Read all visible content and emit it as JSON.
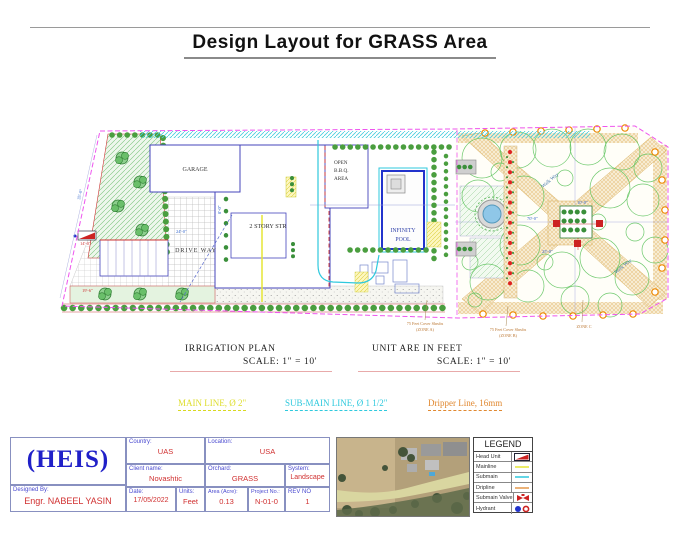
{
  "title": "Design Layout for GRASS Area",
  "plan": {
    "labels": {
      "garage": "GARAGE",
      "two_story": "2 STORY STR",
      "driveway": "DRIVE WAY",
      "bbq1": "OPEN",
      "bbq2": "B.B.Q.",
      "bbq3": "AREA",
      "pool1": "INFINITY",
      "pool2": "POOL",
      "walkway": "Walk Way"
    },
    "dims": {
      "d35": "35'-0\"",
      "d24": "24'-0\"",
      "d14": "14'-0\"",
      "d8": "8'-0\"",
      "d19": "19'-6\"",
      "d70": "70'-0\"",
      "d10": "10'-0\"",
      "d25": "25'-0\""
    },
    "annotations": {
      "a1l1": "75 Feet Cover Shrubs",
      "a1l2": "(ZONE A)",
      "a2l1": "75 Feet Cover Shrubs",
      "a2l2": "(ZONE B)",
      "a3": "ZONE C"
    }
  },
  "notes": {
    "irrigation": "IRRIGATION PLAN",
    "scale_left": "SCALE: 1\" = 10'",
    "units": "UNIT ARE IN FEET",
    "scale_right": "SCALE: 1\" = 10'"
  },
  "pipes": {
    "main": "MAIN LINE, Ø 2\"",
    "submain": "SUB-MAIN LINE, Ø  1 1/2\"",
    "dripper": "Dripper Line, 16mm"
  },
  "titleblock": {
    "logo": "(HEIS)",
    "designed_by_label": "Designed  By:",
    "designed_by": "Engr. NABEEL YASIN",
    "country_label": "Country:",
    "country": "UAS",
    "location_label": "Location:",
    "location": "USA",
    "client_label": "Client  name:",
    "client": "Novashtic",
    "orchard_label": "Orchard:",
    "orchard": "GRASS",
    "system_label": "System:",
    "system": "Landscape",
    "date_label": "Date:",
    "date": "17/05/2022",
    "units_label": "Units:",
    "units": "Feet",
    "area_label": "Area  (Acre):",
    "area": "0.13",
    "project_label": "Project  No.:",
    "project": "N-01-0",
    "rev_label": "REV  NO",
    "rev": "1"
  },
  "legend": {
    "title": "LEGEND",
    "head_unit": "Head Unit",
    "mainline": "Mainline",
    "submain": "Submain",
    "dripline": "Dripline",
    "submain_valve": "Submain Valve",
    "hydrant": "Hydrant"
  },
  "colors": {
    "accent_blue": "#2233cc",
    "value_red": "#d03030",
    "magenta": "#ee55ee",
    "cyan": "#2fc9dd",
    "yellow": "#e6e635",
    "orange": "#ee8800"
  }
}
